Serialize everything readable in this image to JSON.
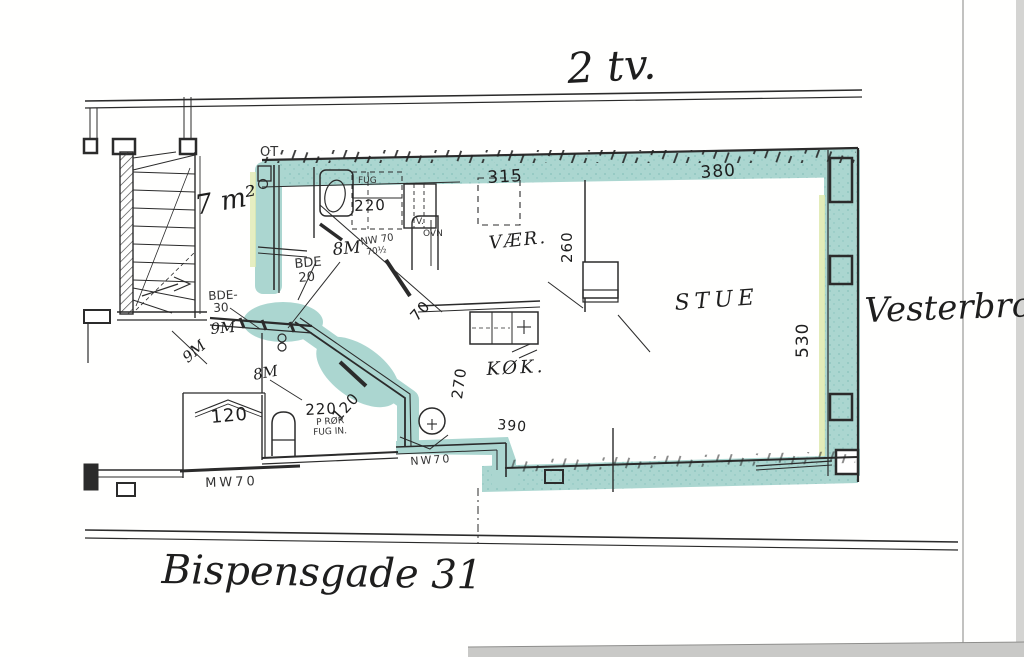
{
  "colors": {
    "highlight": "#9ccfc8",
    "highlight_dark": "#5aa8a0",
    "accent_yellow": "#d9e6a3",
    "ink": "#2b2b2b"
  },
  "titles": {
    "floor": "2 tv.",
    "street_bottom": "Bispensgade 31",
    "street_right": "Vesterbro"
  },
  "rooms": {
    "living": "STUE",
    "bedroom": "VÆR.",
    "kitchen": "KØK.",
    "stair_area": "7 m²",
    "hall_fixture": "OT",
    "oven_v": "V.",
    "oven": "OVN"
  },
  "dimensions": {
    "top_left": "315",
    "top_right": "380",
    "right_wall": "530",
    "bedroom_depth": "260",
    "kitchen_depth": "270",
    "bath_top": "220",
    "bath_bottom": "220",
    "closet": "120",
    "bath_diagonal": "120",
    "door_diagonal": "70",
    "kitchen_bottom": "390"
  },
  "area_marks": {
    "upper_8m": "8M",
    "lower_8m": "8M",
    "hall_9m": "9M",
    "stair_9m": "9M",
    "bde20_line1": "BDE",
    "bde20_line2": "20",
    "bde30_line1": "BDE-",
    "bde30_line2": "30"
  },
  "notes": {
    "nw70_line1": "NW 70",
    "nw70_line2": "70½",
    "nw70_bottom": "NW70",
    "mw70": "MW70",
    "fug": "FUG",
    "p_ror": "P RØR",
    "fug_in": "FUG IN."
  }
}
